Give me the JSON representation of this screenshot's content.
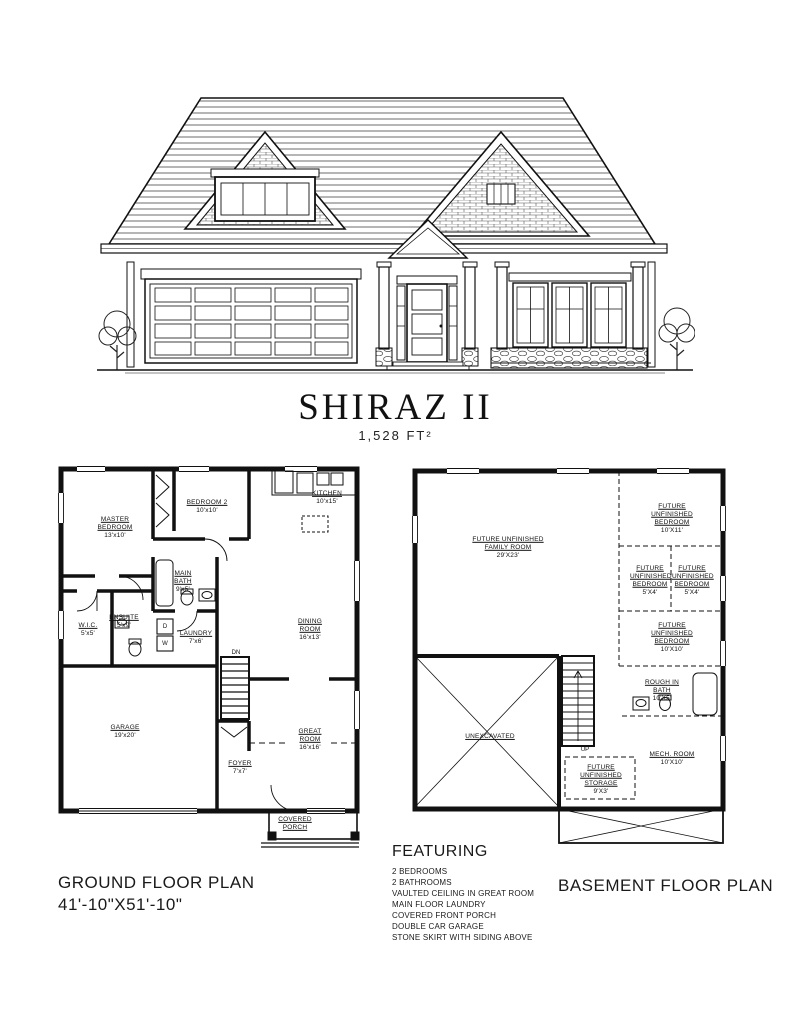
{
  "title": {
    "name": "SHIRAZ II",
    "area": "1,528 FT²"
  },
  "ground_floor": {
    "caption": "GROUND FLOOR PLAN",
    "overall_dimensions": "41'-10\"X51'-10\"",
    "stairs_label": "DN",
    "dryer_label": "D",
    "washer_label": "W",
    "rooms": {
      "master_bedroom": {
        "name": "MASTER BEDROOM",
        "dims": "13'x10'"
      },
      "bedroom2": {
        "name": "BEDROOM 2",
        "dims": "10'x10'"
      },
      "kitchen": {
        "name": "KITCHEN",
        "dims": "10'x15'"
      },
      "dining_room": {
        "name": "DINING ROOM",
        "dims": "16'x13'"
      },
      "great_room": {
        "name": "GREAT ROOM",
        "dims": "16'x16'"
      },
      "garage": {
        "name": "GARAGE",
        "dims": "19'x20'"
      },
      "foyer": {
        "name": "FOYER",
        "dims": "7'x7'"
      },
      "main_bath": {
        "name": "MAIN BATH",
        "dims": "9'x5'"
      },
      "ensuite": {
        "name": "ENSUITE",
        "dims": "5'x9'"
      },
      "wic": {
        "name": "W.I.C.",
        "dims": "5'x5'"
      },
      "laundry": {
        "name": "LAUNDRY",
        "dims": "7'x6'"
      },
      "covered_porch": {
        "name": "COVERED PORCH",
        "dims": ""
      }
    }
  },
  "basement": {
    "caption": "BASEMENT FLOOR PLAN",
    "stairs_label": "UP",
    "rooms": {
      "family_room": {
        "name": "FUTURE UNFINISHED FAMILY ROOM",
        "dims": "29'X23'"
      },
      "bedroom_a": {
        "name": "FUTURE UNFINISHED BEDROOM",
        "dims": "10'X11'"
      },
      "bedroom_b": {
        "name": "FUTURE UNFINISHED BEDROOM",
        "dims": "5'X4'"
      },
      "bedroom_c": {
        "name": "FUTURE UNFINISHED BEDROOM",
        "dims": "5'X4'"
      },
      "bedroom_d": {
        "name": "FUTURE UNFINISHED BEDROOM",
        "dims": "10'X10'"
      },
      "rough_in_bath": {
        "name": "ROUGH IN BATH",
        "dims": "10'X5'"
      },
      "mech_room": {
        "name": "MECH. ROOM",
        "dims": "10'X10'"
      },
      "storage": {
        "name": "FUTURE UNFINISHED STORAGE",
        "dims": "9'X3'"
      },
      "unexcavated": {
        "name": "UNEXCAVATED",
        "dims": ""
      }
    }
  },
  "featuring": {
    "heading": "FEATURING",
    "items": [
      "2 BEDROOMS",
      "2 BATHROOMS",
      "VAULTED CEILING IN GREAT ROOM",
      "MAIN FLOOR LAUNDRY",
      "COVERED FRONT PORCH",
      "DOUBLE CAR GARAGE",
      "STONE SKIRT WITH SIDING ABOVE"
    ]
  }
}
